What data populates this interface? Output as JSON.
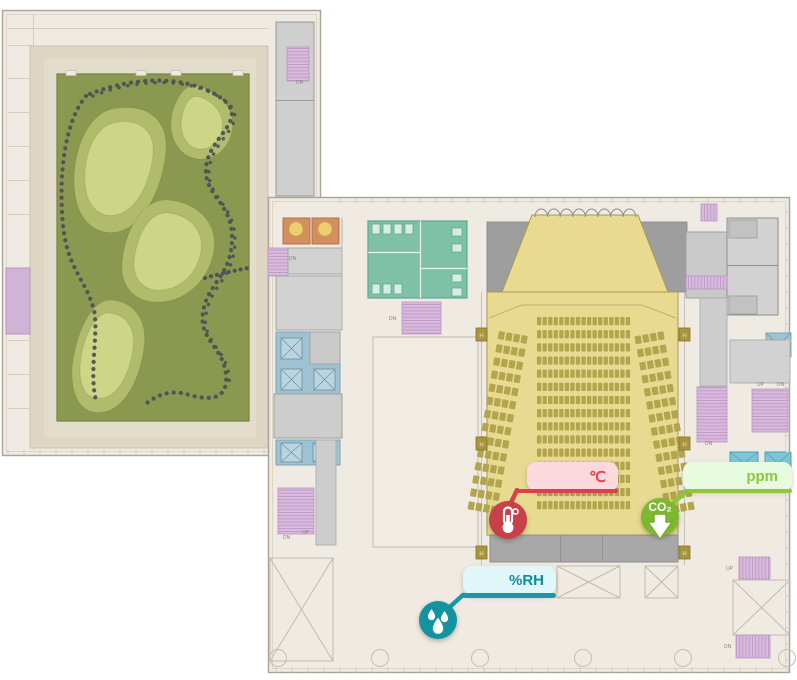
{
  "app": {
    "view_name": "building-floor-plan-with-environment-sensors"
  },
  "sensors": {
    "temperature": {
      "unit_label": "℃",
      "accent_color": "#d8414e",
      "icon_bg": "#c7404a",
      "bubble_bg": "#fcd9dc"
    },
    "co2": {
      "unit_label": "ppm",
      "icon_label": "CO₂",
      "accent_color": "#8dc63f",
      "icon_bg": "#7cb92e",
      "bubble_bg": "#e7fbdf"
    },
    "humidity": {
      "unit_label": "%RH",
      "accent_color": "#1898a8",
      "icon_bg": "#12939f",
      "bubble_bg": "#e0f6f9"
    }
  },
  "plan": {
    "labels": [
      {
        "text": "DN",
        "x": 296,
        "y": 84
      },
      {
        "text": "DN",
        "x": 289,
        "y": 260
      },
      {
        "text": "DN",
        "x": 389,
        "y": 320
      },
      {
        "text": "DN",
        "x": 283,
        "y": 539
      },
      {
        "text": "UP",
        "x": 302,
        "y": 534
      },
      {
        "text": "DN",
        "x": 705,
        "y": 445
      },
      {
        "text": "UP",
        "x": 757,
        "y": 386
      },
      {
        "text": "DN",
        "x": 777,
        "y": 386
      },
      {
        "text": "UP",
        "x": 726,
        "y": 570
      },
      {
        "text": "DN",
        "x": 724,
        "y": 648
      }
    ],
    "hose_markers": {
      "label": "H",
      "positions": [
        [
          476,
          328
        ],
        [
          679,
          328
        ],
        [
          476,
          437
        ],
        [
          679,
          437
        ],
        [
          476,
          546
        ],
        [
          679,
          546
        ]
      ]
    },
    "auditorium": {
      "seating": {
        "seat_color": "#b3a44e",
        "blocks": [
          {
            "name": "center",
            "rows": 15,
            "cols": 17,
            "x": 537,
            "y": 317,
            "dx": 5.55,
            "dy": 13.15,
            "w": 4.3,
            "h": 8.2,
            "angle": 0,
            "ax": 0,
            "ay": 0
          },
          {
            "name": "left",
            "rows": 14,
            "cols": 4,
            "x": 499,
            "y": 331,
            "dx": 7.7,
            "dy": 13.3,
            "w": 6.2,
            "h": 8,
            "angle": 10,
            "ax": 499,
            "ay": 331
          },
          {
            "name": "right",
            "rows": 14,
            "cols": 4,
            "x": 634,
            "y": 331,
            "dx": 7.7,
            "dy": 13.3,
            "w": 6.2,
            "h": 8,
            "angle": -10,
            "ax": 665,
            "ay": 331
          }
        ]
      }
    }
  }
}
